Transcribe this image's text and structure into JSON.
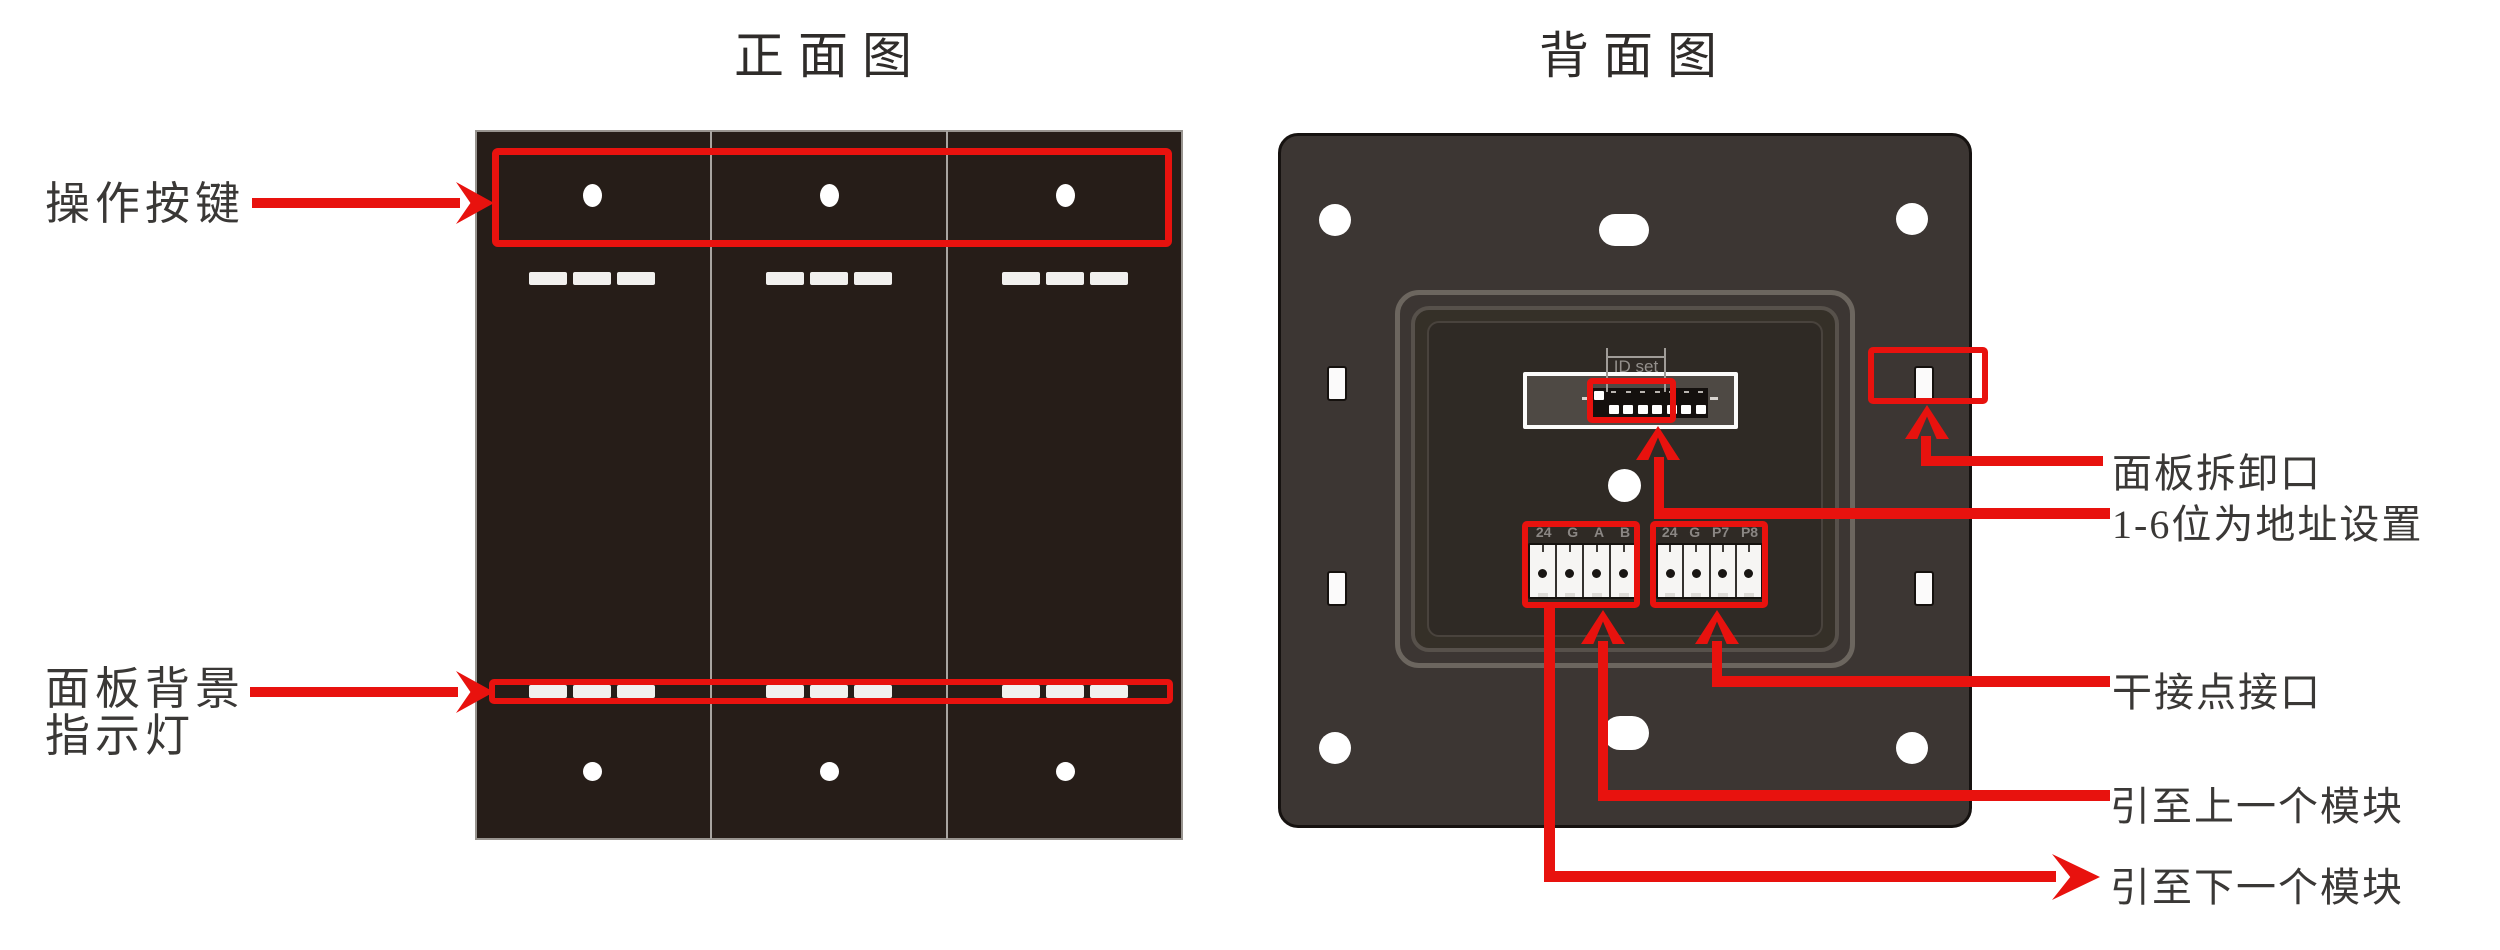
{
  "front": {
    "title": "正面图",
    "annotations": {
      "buttons": "操作按键",
      "backlight_line1": "面板背景",
      "backlight_line2": "指示灯"
    }
  },
  "back": {
    "title": "背面图",
    "dip_label": "ID set",
    "dip_pattern": [
      "up",
      "down",
      "down",
      "down",
      "down",
      "down",
      "down",
      "down"
    ],
    "terminal_left_pins": [
      "24",
      "G",
      "A",
      "B"
    ],
    "terminal_right_pins": [
      "24",
      "G",
      "P7",
      "P8"
    ],
    "annotations": {
      "detach_port": "面板拆卸口",
      "address_setting": "1-6位为地址设置",
      "dry_contact": "干接点接口",
      "to_prev_module": "引至上一个模块",
      "to_next_module": "引至下一个模块"
    }
  },
  "colors": {
    "annotation_red": "#e8120e",
    "front_panel": "#261d18",
    "back_panel": "#3c3633",
    "label_text": "#3a3836",
    "pin_label_gray": "#8a8683"
  }
}
